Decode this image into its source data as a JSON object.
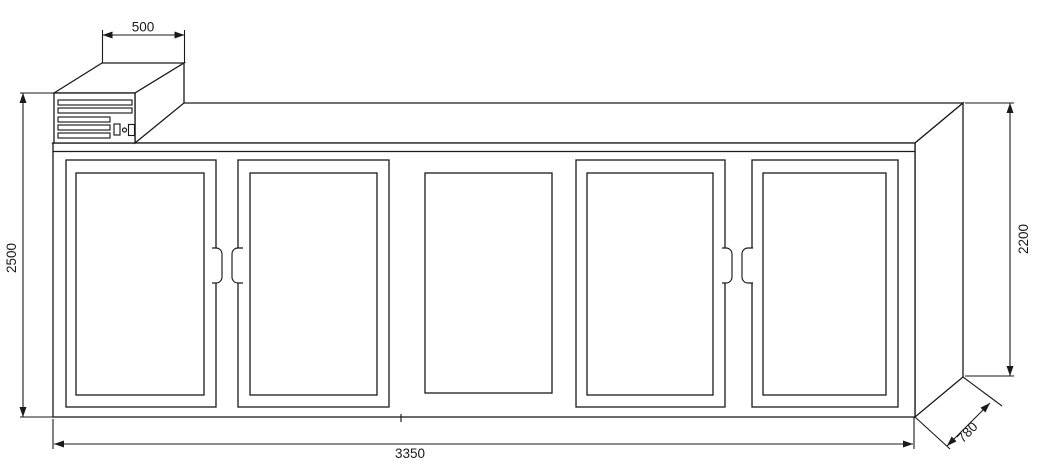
{
  "drawing": {
    "type": "dimensioned technical line drawing",
    "subject": "five-door refrigerated cabinet with top-mounted condensing unit",
    "door_count": 5,
    "colors": {
      "background": "#ffffff",
      "line": "#1a1a1a"
    },
    "dims": {
      "condenser_width": "500",
      "overall_height": "2500",
      "cabinet_height": "2200",
      "cabinet_width": "3350",
      "cabinet_depth": "780"
    }
  }
}
